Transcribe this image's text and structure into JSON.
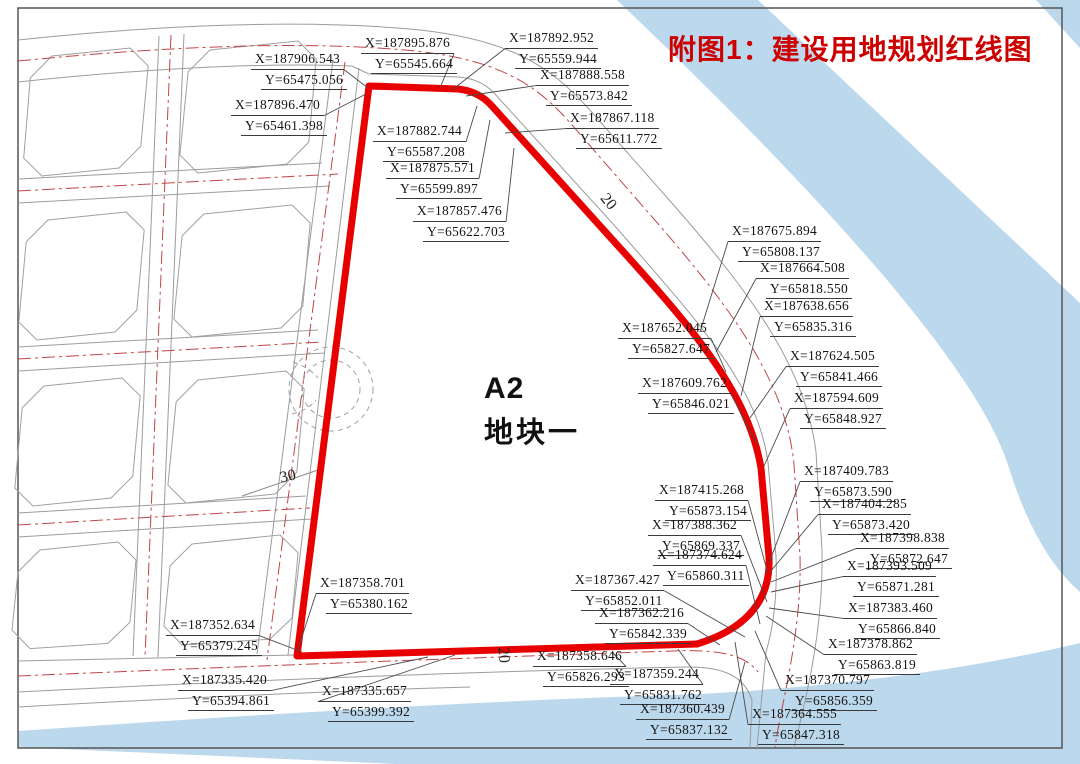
{
  "title": "附图1：建设用地规划红线图",
  "parcel": {
    "code": "A2",
    "name": "地块一"
  },
  "colors": {
    "boundary_red": "#e80000",
    "water_blue": "#bcd8ec",
    "centerline_red": "#c04545",
    "title_red": "#cc0000"
  },
  "road_width_labels": [
    {
      "value": "20",
      "x": 600,
      "y": 193,
      "rot": 50
    },
    {
      "value": "30",
      "x": 280,
      "y": 468,
      "rot": -12
    },
    {
      "value": "20",
      "x": 495,
      "y": 646,
      "rot": 86
    }
  ],
  "coordinate_labels": [
    {
      "x_text": "X=187906.543",
      "y_text": "Y=65475.056",
      "px": 251,
      "py": 49,
      "ax": 368,
      "ay": 88,
      "side": "right"
    },
    {
      "x_text": "X=187896.470",
      "y_text": "Y=65461.398",
      "px": 231,
      "py": 95,
      "ax": 366,
      "ay": 94,
      "side": "right"
    },
    {
      "x_text": "X=187895.876",
      "y_text": "Y=65545.664",
      "px": 361,
      "py": 33,
      "ax": 440,
      "ay": 88,
      "side": "right"
    },
    {
      "x_text": "X=187892.952",
      "y_text": "Y=65559.944",
      "px": 505,
      "py": 28,
      "ax": 452,
      "ay": 90,
      "side": "left"
    },
    {
      "x_text": "X=187888.558",
      "y_text": "Y=65573.842",
      "px": 536,
      "py": 65,
      "ax": 466,
      "ay": 96,
      "side": "left"
    },
    {
      "x_text": "X=187867.118",
      "y_text": "Y=65611.772",
      "px": 566,
      "py": 108,
      "ax": 505,
      "ay": 133,
      "side": "left"
    },
    {
      "x_text": "X=187882.744",
      "y_text": "Y=65587.208",
      "px": 373,
      "py": 121,
      "ax": 477,
      "ay": 106,
      "side": "right"
    },
    {
      "x_text": "X=187875.571",
      "y_text": "Y=65599.897",
      "px": 386,
      "py": 158,
      "ax": 490,
      "ay": 120,
      "side": "right"
    },
    {
      "x_text": "X=187857.476",
      "y_text": "Y=65622.703",
      "px": 413,
      "py": 201,
      "ax": 514,
      "ay": 148,
      "side": "right"
    },
    {
      "x_text": "X=187675.894",
      "y_text": "Y=65808.137",
      "px": 728,
      "py": 221,
      "ax": 700,
      "ay": 332,
      "side": "left"
    },
    {
      "x_text": "X=187664.508",
      "y_text": "Y=65818.550",
      "px": 756,
      "py": 258,
      "ax": 716,
      "ay": 352,
      "side": "left"
    },
    {
      "x_text": "X=187638.656",
      "y_text": "Y=65835.316",
      "px": 760,
      "py": 296,
      "ax": 741,
      "ay": 396,
      "side": "left"
    },
    {
      "x_text": "X=187652.045",
      "y_text": "Y=65827.647",
      "px": 618,
      "py": 318,
      "ax": 726,
      "ay": 372,
      "side": "right"
    },
    {
      "x_text": "X=187624.505",
      "y_text": "Y=65841.466",
      "px": 786,
      "py": 346,
      "ax": 750,
      "ay": 418,
      "side": "left"
    },
    {
      "x_text": "X=187609.762",
      "y_text": "Y=65846.021",
      "px": 638,
      "py": 373,
      "ax": 757,
      "ay": 444,
      "side": "right"
    },
    {
      "x_text": "X=187594.609",
      "y_text": "Y=65848.927",
      "px": 790,
      "py": 388,
      "ax": 764,
      "ay": 466,
      "side": "left"
    },
    {
      "x_text": "X=187415.268",
      "y_text": "Y=65873.154",
      "px": 655,
      "py": 480,
      "ax": 768,
      "ay": 574,
      "side": "right"
    },
    {
      "x_text": "X=187409.783",
      "y_text": "Y=65873.590",
      "px": 800,
      "py": 461,
      "ax": 769,
      "ay": 563,
      "side": "left"
    },
    {
      "x_text": "X=187404.285",
      "y_text": "Y=65873.420",
      "px": 818,
      "py": 494,
      "ax": 770,
      "ay": 572,
      "side": "left"
    },
    {
      "x_text": "X=187398.838",
      "y_text": "Y=65872.647",
      "px": 856,
      "py": 528,
      "ax": 771,
      "ay": 582,
      "side": "left"
    },
    {
      "x_text": "X=187393.509",
      "y_text": "Y=65871.281",
      "px": 843,
      "py": 556,
      "ax": 771,
      "ay": 592,
      "side": "left"
    },
    {
      "x_text": "X=187388.362",
      "y_text": "Y=65869.337",
      "px": 648,
      "py": 515,
      "ax": 767,
      "ay": 602,
      "side": "right"
    },
    {
      "x_text": "X=187383.460",
      "y_text": "Y=65866.840",
      "px": 844,
      "py": 598,
      "ax": 769,
      "ay": 608,
      "side": "left"
    },
    {
      "x_text": "X=187378.862",
      "y_text": "Y=65863.819",
      "px": 824,
      "py": 634,
      "ax": 766,
      "ay": 616,
      "side": "left"
    },
    {
      "x_text": "X=187374.624",
      "y_text": "Y=65860.311",
      "px": 653,
      "py": 545,
      "ax": 760,
      "ay": 624,
      "side": "right"
    },
    {
      "x_text": "X=187370.797",
      "y_text": "Y=65856.359",
      "px": 781,
      "py": 670,
      "ax": 755,
      "ay": 631,
      "side": "left"
    },
    {
      "x_text": "X=187367.427",
      "y_text": "Y=65852.011",
      "px": 571,
      "py": 570,
      "ax": 745,
      "ay": 637,
      "side": "right"
    },
    {
      "x_text": "X=187364.555",
      "y_text": "Y=65847.318",
      "px": 748,
      "py": 704,
      "ax": 735,
      "ay": 642,
      "side": "left"
    },
    {
      "x_text": "X=187362.216",
      "y_text": "Y=65842.339",
      "px": 595,
      "py": 603,
      "ax": 720,
      "ay": 645,
      "side": "right"
    },
    {
      "x_text": "X=187358.646",
      "y_text": "Y=65826.293",
      "px": 533,
      "py": 646,
      "ax": 612,
      "ay": 652,
      "side": "right"
    },
    {
      "x_text": "X=187359.244",
      "y_text": "Y=65831.762",
      "px": 610,
      "py": 664,
      "ax": 678,
      "ay": 649,
      "side": "right"
    },
    {
      "x_text": "X=187360.439",
      "y_text": "Y=65837.132",
      "px": 636,
      "py": 699,
      "ax": 745,
      "ay": 662,
      "side": "right"
    },
    {
      "x_text": "X=187358.701",
      "y_text": "Y=65380.162",
      "px": 316,
      "py": 573,
      "ax": 298,
      "ay": 649,
      "side": "left"
    },
    {
      "x_text": "X=187352.634",
      "y_text": "Y=65379.245",
      "px": 166,
      "py": 615,
      "ax": 302,
      "ay": 652,
      "side": "right"
    },
    {
      "x_text": "X=187335.420",
      "y_text": "Y=65394.861",
      "px": 178,
      "py": 670,
      "ax": 428,
      "ay": 657,
      "side": "right"
    },
    {
      "x_text": "X=187335.657",
      "y_text": "Y=65399.392",
      "px": 318,
      "py": 681,
      "ax": 455,
      "ay": 655,
      "side": "left"
    }
  ]
}
